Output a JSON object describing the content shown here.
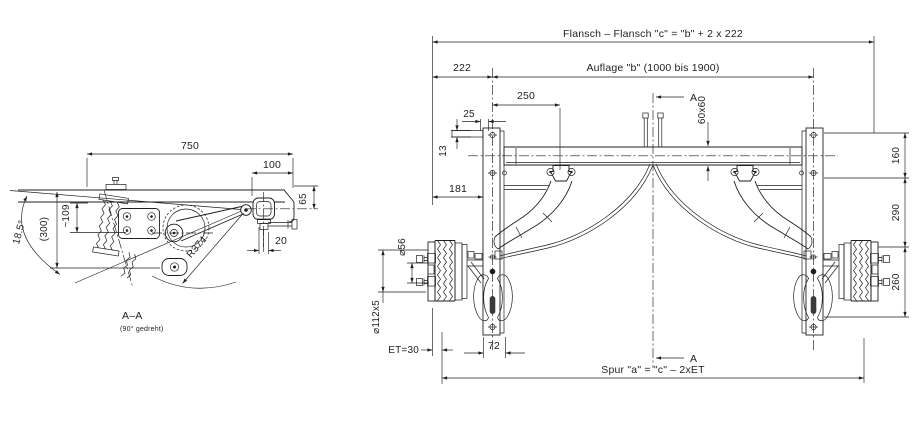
{
  "style": {
    "line_color": "#1f1f1f",
    "bg_color": "#ffffff"
  },
  "side_view": {
    "dim_750": "750",
    "dim_100": "100",
    "dim_109": "~109",
    "dim_65": "65",
    "dim_300": "(300)",
    "dim_angle": "18.5°",
    "dim_r374": "R374",
    "dim_20": "20",
    "section_label": "A–A",
    "section_note": "(90° gedreht)"
  },
  "front_view": {
    "dim_flansch": "Flansch – Flansch \"c\" = \"b\" + 2 x 222",
    "dim_222": "222",
    "dim_auflage": "Auflage \"b\" (1000 bis 1900)",
    "dim_250": "250",
    "dim_25": "25",
    "dim_13": "13",
    "dim_181": "181",
    "dim_60x60": "60x60",
    "dim_160": "160",
    "dim_290": "290",
    "dim_260": "260",
    "dim_d56": "⌀56",
    "dim_d112": "⌀112x5",
    "dim_et": "ET=30",
    "dim_72": "72",
    "dim_spur": "Spur \"a\" = \"c\" – 2xET",
    "section_marker": "A"
  }
}
